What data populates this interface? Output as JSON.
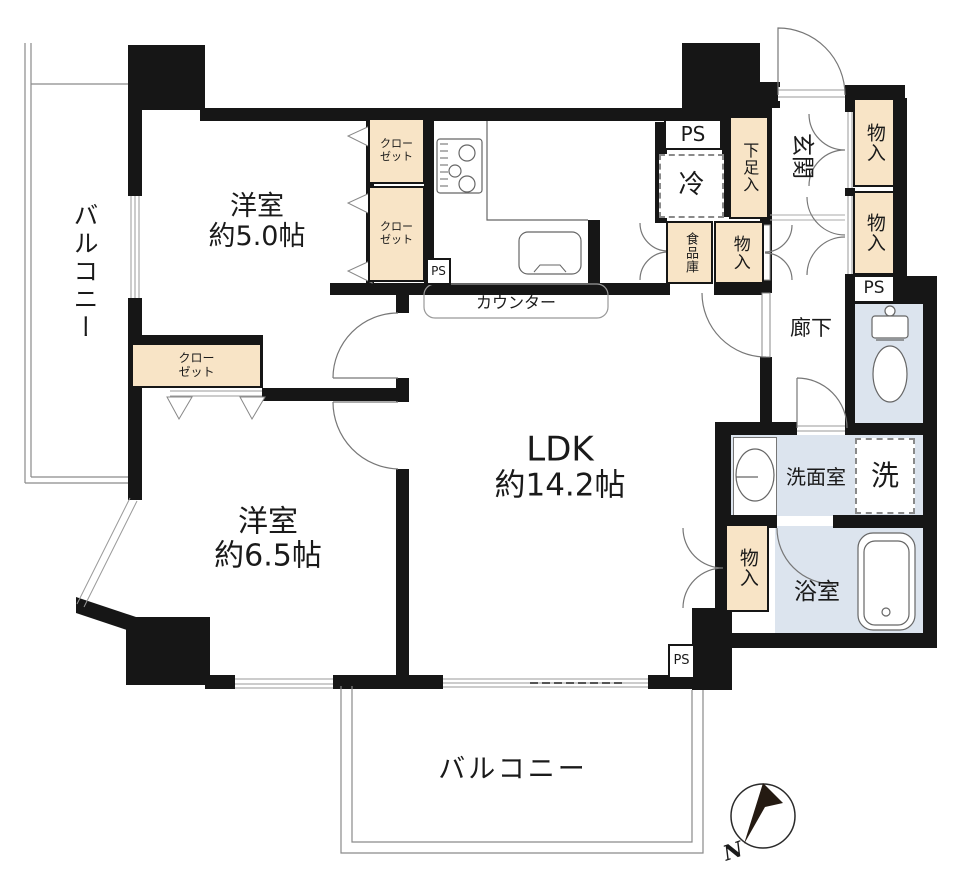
{
  "floorplan": {
    "rooms": {
      "bedroom1": {
        "name": "洋室",
        "size": "約5.0帖"
      },
      "bedroom2": {
        "name": "洋室",
        "size": "約6.5帖"
      },
      "ldk": {
        "name": "LDK",
        "size": "約14.2帖"
      },
      "entrance": {
        "name": "玄関"
      },
      "hallway": {
        "name": "廊下"
      },
      "washroom": {
        "name": "洗面室"
      },
      "bathroom": {
        "name": "浴室"
      },
      "balcony_left": {
        "name": "バルコニー"
      },
      "balcony_bottom": {
        "name": "バルコニー"
      }
    },
    "fixtures": {
      "closet1": "クローゼット",
      "closet2": "クローゼット",
      "closet3": "クローゼット",
      "shoe_cabinet": "下足入",
      "pantry": "食品庫",
      "storage1": "物入",
      "storage2": "物入",
      "storage3": "物入",
      "storage4": "物入",
      "refrigerator": "冷",
      "washer": "洗",
      "counter": "カウンター",
      "ps1": "PS",
      "ps2": "PS",
      "ps3": "PS",
      "ps4": "PS",
      "compass_north": "N"
    },
    "colors": {
      "wall": "#161616",
      "storage_fill": "#f8e4c6",
      "wet_area_fill": "#dce4ee"
    },
    "icons": {
      "kitchen": "stove-icon / sink-icon",
      "sanitary": "toilet-icon / bathtub-icon / washbasin-icon",
      "orientation": "compass-icon"
    }
  }
}
